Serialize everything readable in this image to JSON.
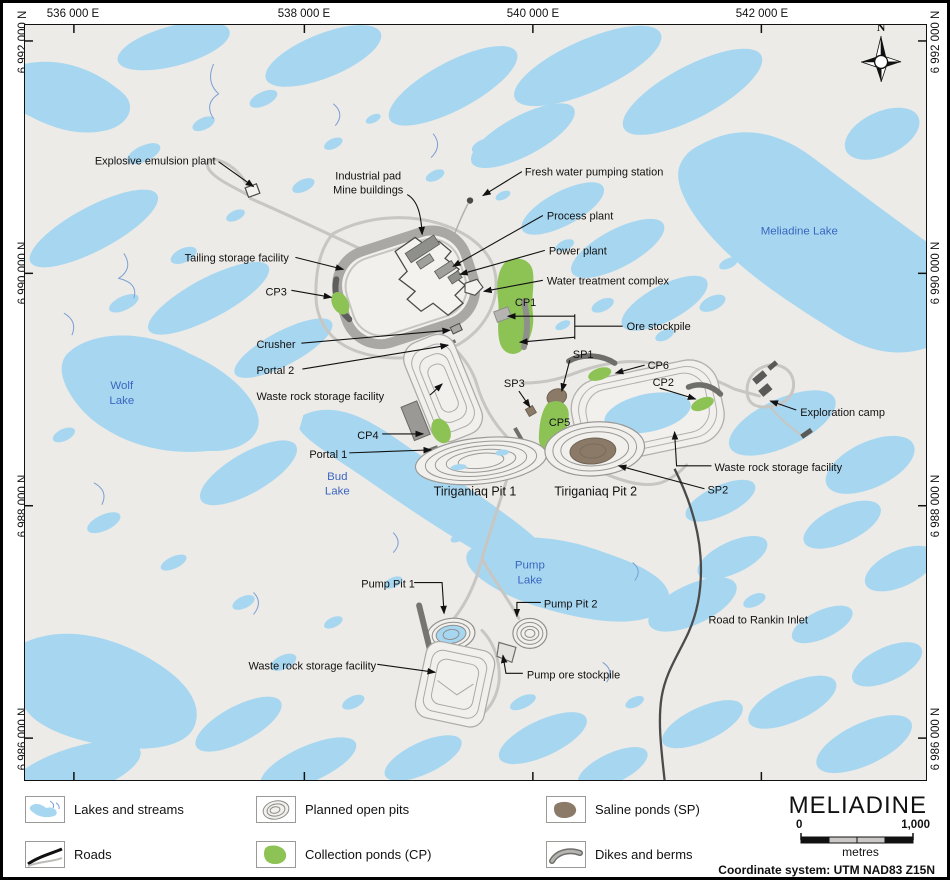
{
  "axes": {
    "top": [
      "536 000 E",
      "538 000 E",
      "540 000 E",
      "542 000 E"
    ],
    "left": [
      "6 992 000 N",
      "6 990 000 N",
      "6 988 000 N",
      "6 986 000 N"
    ],
    "right": [
      "6 992 000 N",
      "6 990 000 N",
      "6 988 000 N",
      "6 986 000 N"
    ]
  },
  "compass": {
    "north_label": "N"
  },
  "map_labels": {
    "explosive_emulsion_plant": "Explosive emulsion plant",
    "industrial_pad_line1": "Industrial pad",
    "industrial_pad_line2": "Mine buildings",
    "fresh_water_pumping_station": "Fresh water pumping station",
    "process_plant": "Process plant",
    "power_plant": "Power plant",
    "water_treatment_complex": "Water treatment complex",
    "ore_stockpile": "Ore stockpile",
    "tailing_storage_facility": "Tailing storage facility",
    "crusher": "Crusher",
    "portal_1": "Portal 1",
    "portal_2": "Portal 2",
    "cp1": "CP1",
    "cp2": "CP2",
    "cp3": "CP3",
    "cp4": "CP4",
    "cp5": "CP5",
    "cp6": "CP6",
    "sp1": "SP1",
    "sp2": "SP2",
    "sp3": "SP3",
    "waste_rock_storage_facility_west": "Waste rock storage facility",
    "waste_rock_storage_facility_east": "Waste rock storage facility",
    "waste_rock_storage_facility_south": "Waste rock storage facility",
    "tiriganiaq_pit_1": "Tiriganiaq  Pit 1",
    "tiriganiaq_pit_2": "Tiriganiaq  Pit 2",
    "pump_pit_1": "Pump Pit 1",
    "pump_pit_2": "Pump Pit 2",
    "pump_ore_stockpile": "Pump ore stockpile",
    "exploration_camp": "Exploration camp",
    "road_to_rankin_inlet": "Road to Rankin Inlet"
  },
  "lake_labels": {
    "wolf": [
      "Wolf",
      "Lake"
    ],
    "bud": [
      "Bud",
      "Lake"
    ],
    "pump": [
      "Pump",
      "Lake"
    ],
    "meliadine": "Meliadine Lake"
  },
  "legend": {
    "items": [
      {
        "label": "Lakes and streams"
      },
      {
        "label": "Roads"
      },
      {
        "label": "Planned open pits"
      },
      {
        "label": "Collection ponds (CP)"
      },
      {
        "label": "Saline ponds (SP)"
      },
      {
        "label": "Dikes and berms"
      }
    ],
    "title": "MELIADINE",
    "scale": {
      "start": "0",
      "end": "1,000",
      "unit": "metres"
    },
    "coordinate_system": "Coordinate system: UTM NAD83 Z15N"
  },
  "colors": {
    "lake": "#a7d7f0",
    "land": "#edebe7",
    "collection_pond": "#8dc355",
    "saline_pond": "#8b7a67",
    "road": "#c7c6c2",
    "dark_road": "#4b4b4b",
    "lake_label": "#3a66c0"
  }
}
